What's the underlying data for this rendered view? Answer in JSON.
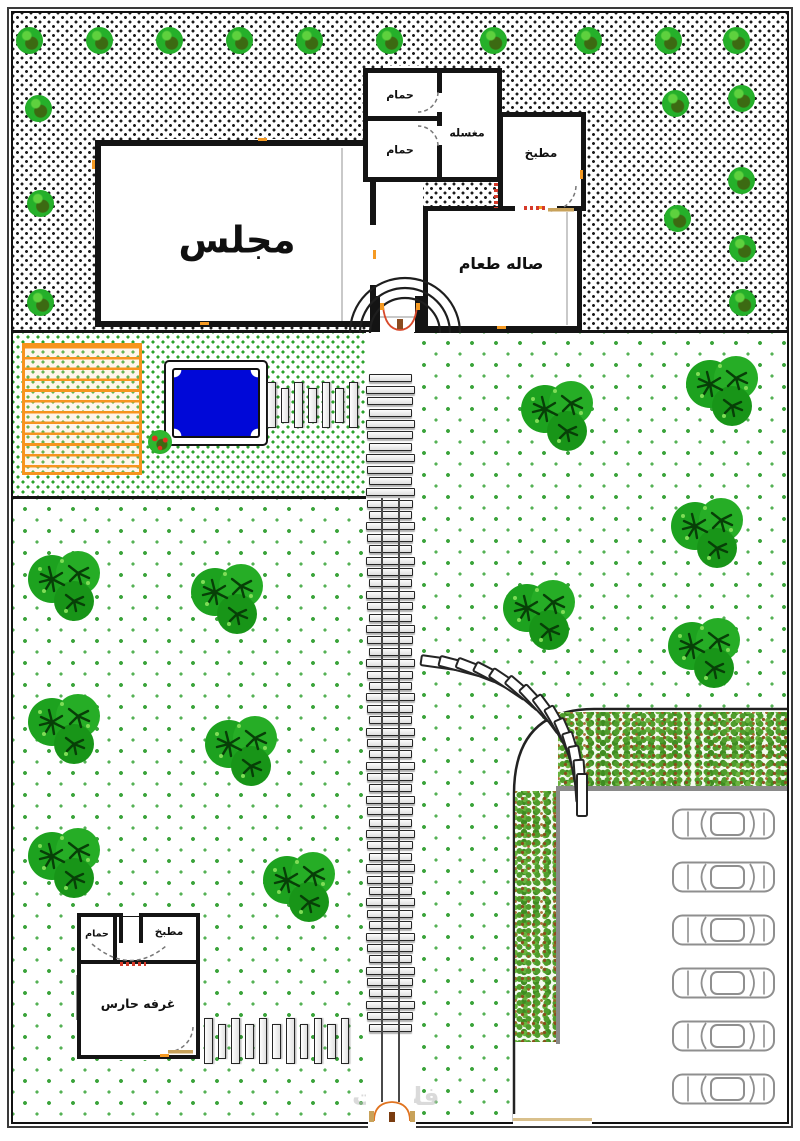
{
  "labels": {
    "majlis": "مجلس",
    "bathroom_1": "حمام",
    "bathroom_2": "حمام",
    "laundry": "مغسله",
    "kitchen": "مطبخ",
    "dining": "صاله طعام",
    "guard_bathroom": "حمام",
    "guard_kitchen": "مطبخ",
    "guard_room": "غرفه حارس"
  },
  "watermark": {
    "text": "فلامنت"
  },
  "parking": {
    "car_count": 6
  },
  "vegetation": {
    "border_bushes": 19,
    "garden_trees": 11
  },
  "colors": {
    "pool_blue": "#0008d8",
    "pergola_orange": "#f7941d",
    "tree_green": "#25b02a",
    "hedge_green": "#4f9d2c",
    "hedge_brown": "#8b4a1a",
    "window_orange": "#f59a23",
    "door_red": "#d8492b",
    "wall_black": "#141414"
  }
}
